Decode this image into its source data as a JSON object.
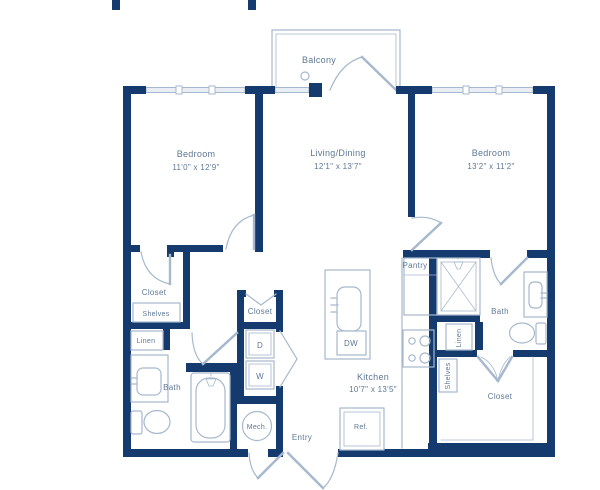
{
  "title": "Two bedroom apartment floor plan",
  "colors": {
    "wall": "#153a6d",
    "fixture_line": "#a6b8cd",
    "label_text": "#5e7896",
    "window_fill": "#e9eef4",
    "background": "#ffffff"
  },
  "labels": {
    "balcony": "Balcony",
    "bedroom_left": "Bedroom",
    "bedroom_left_dims": "11'0\" x 12'9\"",
    "living": "Living/Dining",
    "living_dims": "12'1\" x 13'7\"",
    "bedroom_right": "Bedroom",
    "bedroom_right_dims": "13'2\" x 11'2\"",
    "kitchen": "Kitchen",
    "kitchen_dims": "10'7\" x 13'5\"",
    "closet_bedroom_left": "Closet",
    "shelves_left": "Shelves",
    "linen_left": "Linen",
    "bath_left": "Bath",
    "closet_hall": "Closet",
    "dryer": "D",
    "washer": "W",
    "mech": "Mech.",
    "entry": "Entry",
    "dishwasher": "DW",
    "refrigerator": "Ref.",
    "pantry": "Pantry",
    "bath_right": "Bath",
    "linen_right": "Linen",
    "shelves_right": "Shelves",
    "closet_right": "Closet"
  }
}
